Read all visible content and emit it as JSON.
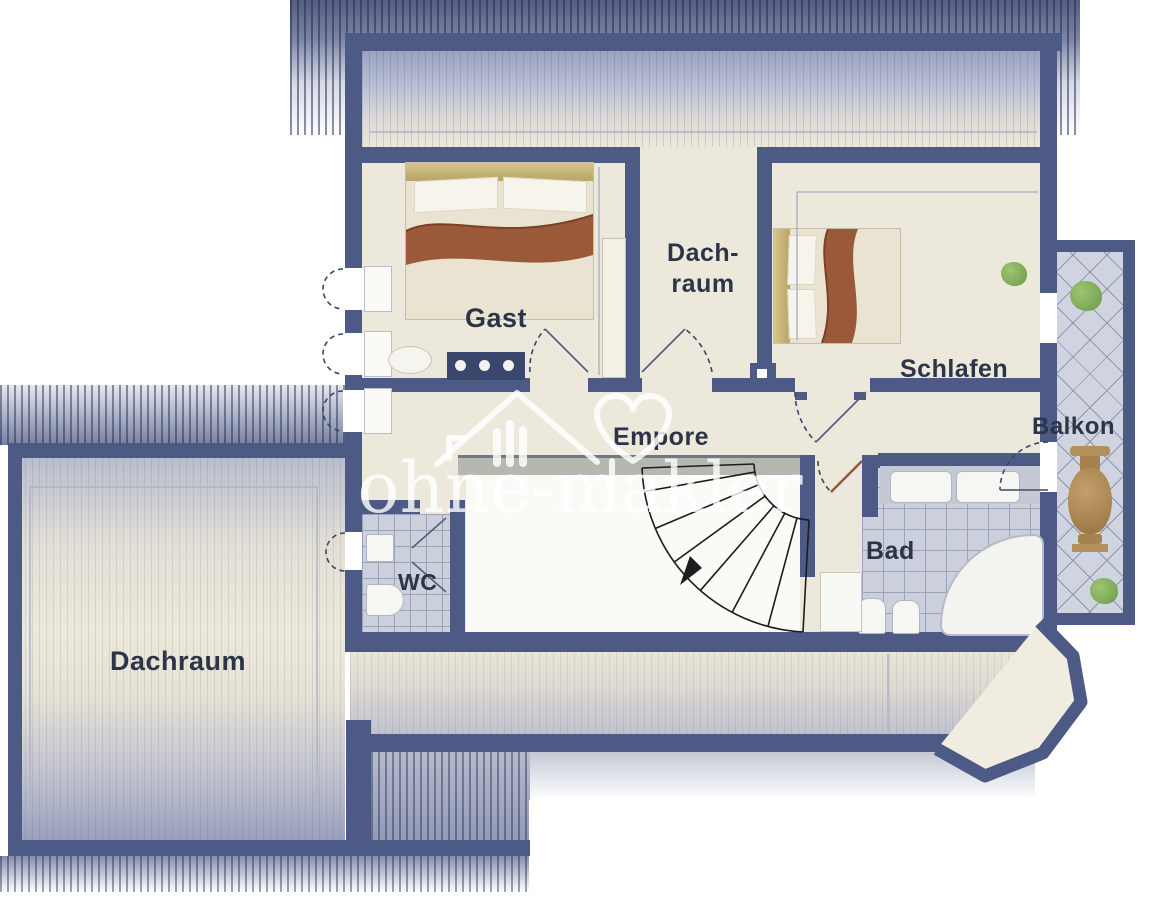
{
  "floorplan": {
    "watermark": {
      "text": "ohne-makler"
    },
    "rooms": [
      {
        "id": "gast",
        "label": "Gast"
      },
      {
        "id": "dachraum-mitte",
        "line1": "Dach-",
        "line2": "raum"
      },
      {
        "id": "schlafen",
        "label": "Schlafen"
      },
      {
        "id": "balkon",
        "label": "Balkon"
      },
      {
        "id": "empore",
        "label": "Empore"
      },
      {
        "id": "wc",
        "label": "WC"
      },
      {
        "id": "bad",
        "label": "Bad"
      },
      {
        "id": "dachraum-links",
        "label": "Dachraum"
      }
    ],
    "colors": {
      "wall": "#4d5a86",
      "floor": "#ece8db",
      "roof_dark": "#47537e",
      "tile": "#ccd0dc",
      "bed_blanket": "#9a5a39",
      "plant": "#7fae57",
      "label_text": "#2d3447",
      "watermark": "#ffffff"
    }
  }
}
